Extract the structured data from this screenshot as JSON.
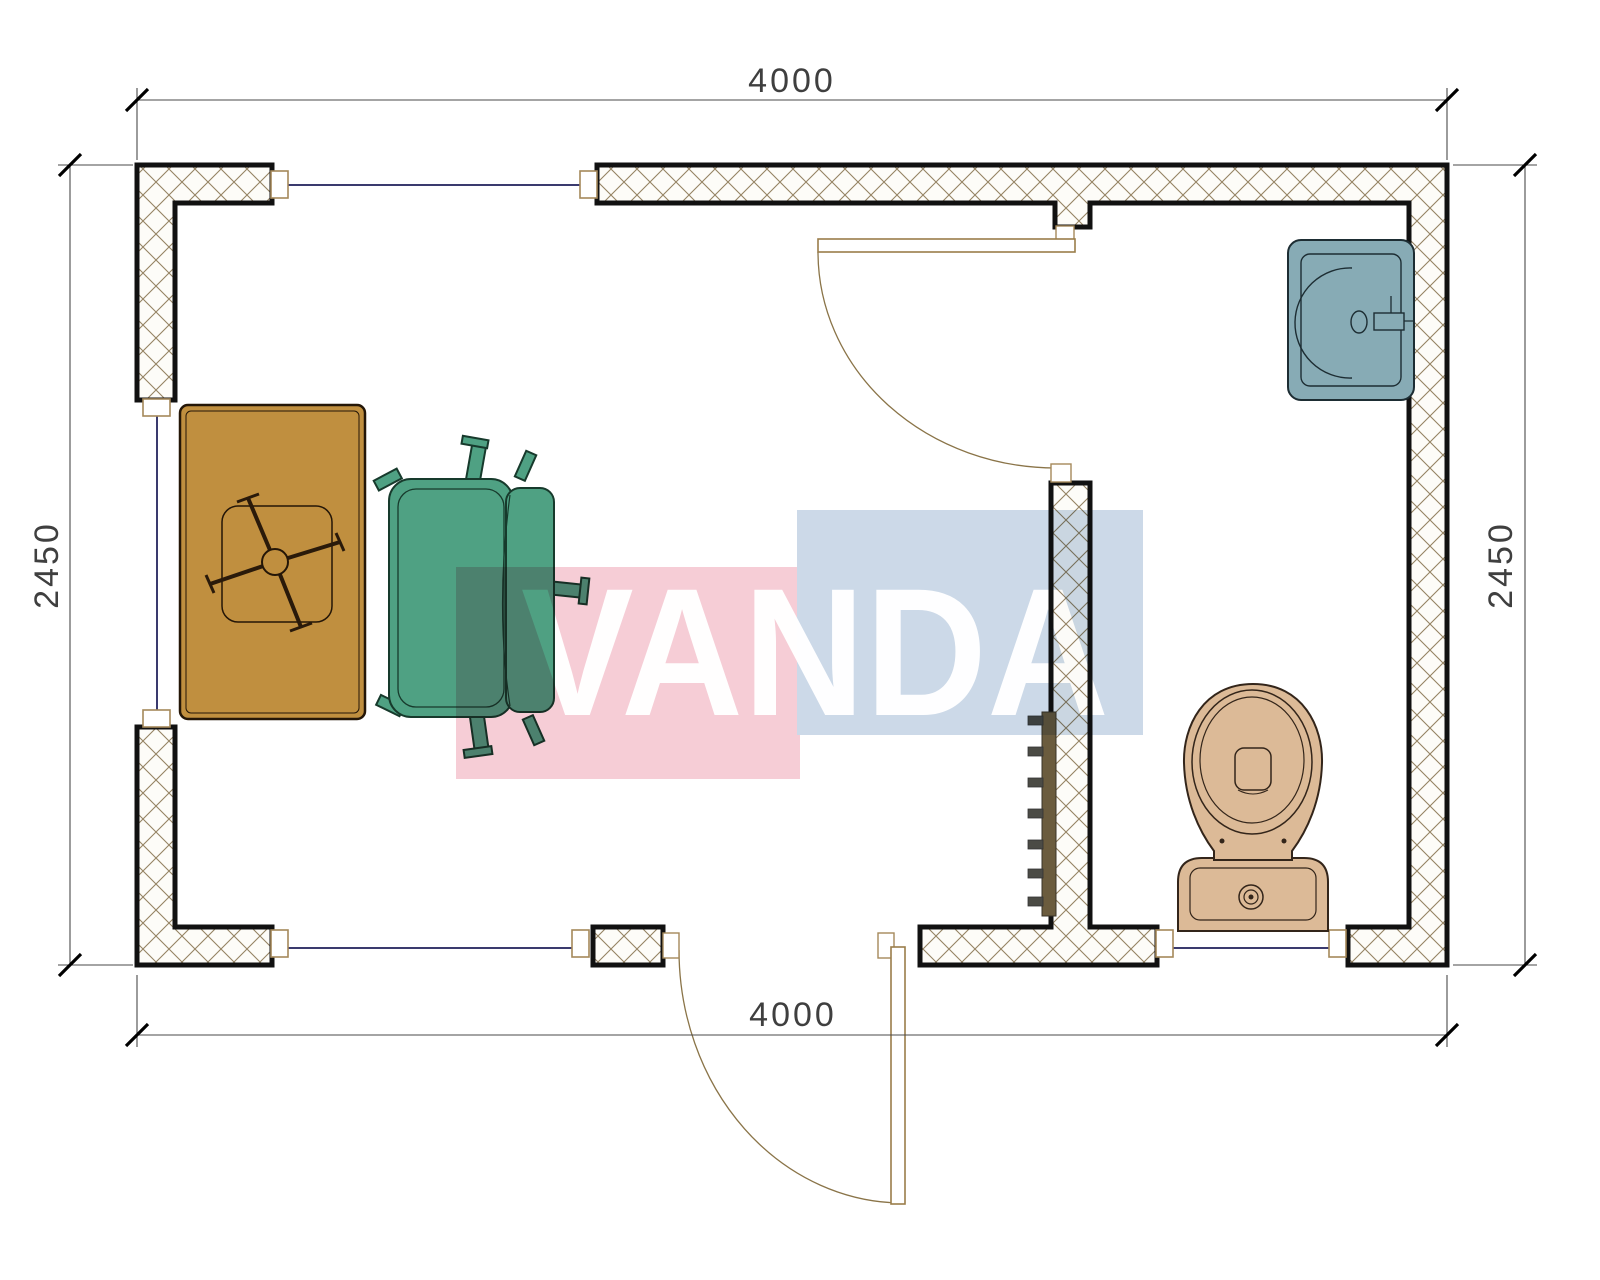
{
  "floor_plan": {
    "dimensions": {
      "top": "4000",
      "bottom": "4000",
      "left": "2450",
      "right": "2450"
    },
    "watermark": {
      "text": "VANDA",
      "pink_color": "#f6cdd6",
      "blue_color": "#ccd9e8",
      "text_color": "#ffffff"
    },
    "colors": {
      "wall_outline": "#111111",
      "wall_fill": "#fdfcf8",
      "hatch_line": "#958363",
      "window_glass": "#3a3a6e",
      "door_frame": "#a5895a",
      "door_leaf": "#9a7d4a",
      "door_swing": "#8a7448",
      "dim_line": "#4a4a4a",
      "dim_tick": "#000000",
      "dim_text": "#3f3f3f",
      "desk": "#c08f3f",
      "desk_outline": "#241607",
      "chair": "#4fa183",
      "chair_outline": "#173a2c",
      "sink": "#87abb5",
      "sink_outline": "#1d2d33",
      "toilet": "#dcba97",
      "toilet_outline": "#33251a",
      "radiator": "#6b5c3e",
      "radiator_tab": "#4b4b45"
    },
    "fixtures": {
      "desk": "desk",
      "chair": "office-chair",
      "sink": "sink",
      "toilet": "toilet",
      "radiator": "radiator",
      "interior_door": "interior-door",
      "exterior_door": "exterior-door"
    }
  }
}
